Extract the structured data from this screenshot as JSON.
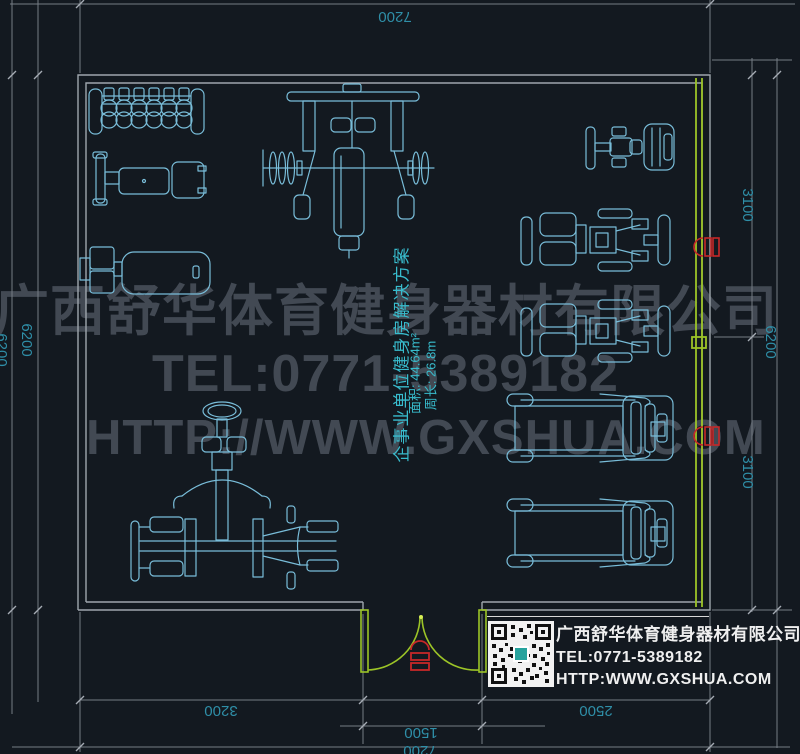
{
  "watermark": {
    "company": "广西舒华体育健身器材有限公司",
    "tel": "TEL:0771-5389182",
    "website": "HTTP://WWW.GXSHUA.COM"
  },
  "plan_label": {
    "title": "企事业单位健身房解决方案",
    "area": "面积: 44.64m²",
    "perimeter": "周长: 26.8m"
  },
  "dimensions": {
    "top_width": "7200",
    "left_height": "6200",
    "left_outer": "6200",
    "right_upper": "3100",
    "right_lower": "3100",
    "right_total": "6200",
    "bottom_seg_left": "3200",
    "door_width": "1500",
    "bottom_seg_right": "2500",
    "bottom_total": "7200"
  },
  "info_card": {
    "company": "广西舒华体育健身器材有限公司",
    "tel": "TEL:0771-5389182",
    "website": "HTTP:WWW.GXSHUA.COM"
  },
  "equipment_ids": [
    "dumbbell-rack",
    "adjustable-bench",
    "flat-bench",
    "multi-gym-station",
    "multi-station-trainer",
    "exercise-bike",
    "recumbent-machine-1",
    "recumbent-machine-2",
    "treadmill-1",
    "treadmill-2"
  ],
  "colors": {
    "background": "#131920",
    "equipment_cyan": "#79bdd9",
    "dimension_teal": "#2f8fa8",
    "label_cyan": "#38bccd",
    "wall_gray": "#9fa6ad",
    "accent_green": "#9cc427",
    "marker_red": "#c62828",
    "watermark_gray": "#474e58"
  }
}
